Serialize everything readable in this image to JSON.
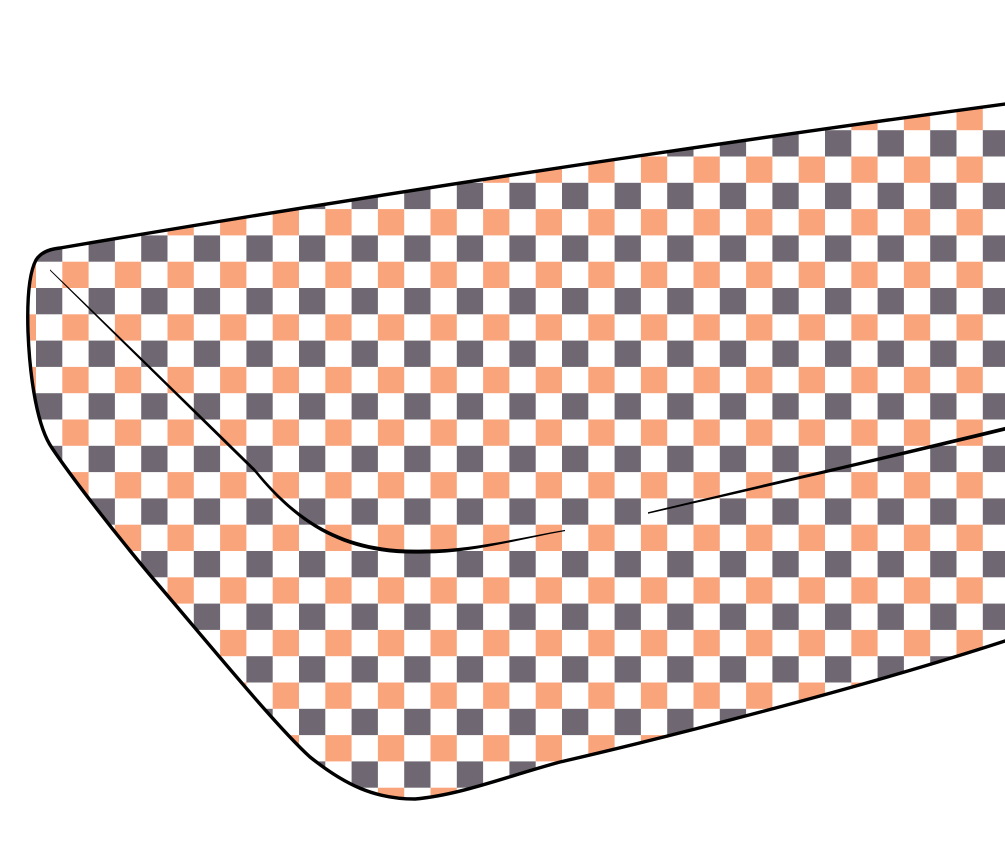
{
  "page": {
    "background": "#FFFFFF"
  },
  "illustration": {
    "name": "checkered-mattress",
    "subject": "Perspective line drawing of a rounded-corner mattress pad covered in checkerboard fabric, cropped by the right edge of the image",
    "colors": {
      "outline": "#000000",
      "checker_gray": "#6F6872",
      "checker_orange": "#FAA47C",
      "checker_white": "#FFFFFF"
    },
    "pattern": {
      "type": "checkerboard",
      "square_px": 26.3,
      "period_px": 52.6,
      "origin_x": 36,
      "origin_y": 25,
      "description": "rows of gray/white squares alternating with offset rows of orange/white squares"
    }
  }
}
